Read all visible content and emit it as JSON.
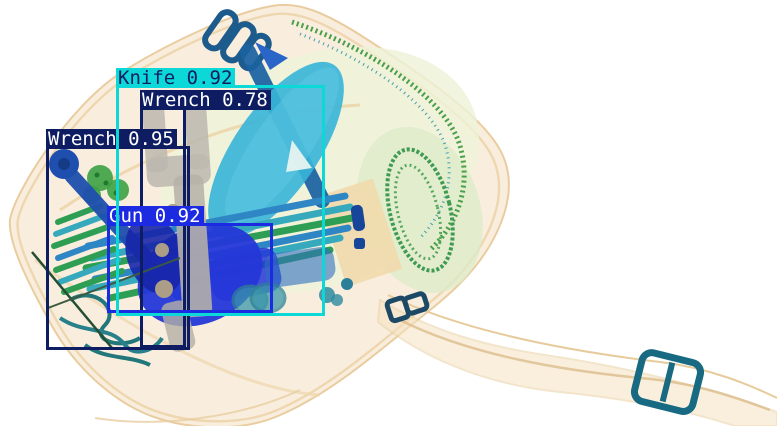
{
  "image": {
    "kind": "xray-baggage-scan",
    "background": "#ffffff"
  },
  "palette": {
    "cyan_box": "#0cd8d8",
    "navy_box": "#0e1d62",
    "blue_box": "#1c2ae2",
    "label_text_light": "#ffffff",
    "label_text_dark": "#0e1d62"
  },
  "detections": [
    {
      "label": "Wrench",
      "score": "0.78",
      "display": "Wrench 0.78",
      "color": "#0e1d62",
      "text_color": "#ffffff",
      "stroke": 3,
      "box": {
        "x": 140,
        "y": 107,
        "w": 46,
        "h": 241
      }
    },
    {
      "label": "Wrench",
      "score": "0.95",
      "display": "Wrench 0.95",
      "color": "#0e1d62",
      "text_color": "#ffffff",
      "stroke": 3,
      "box": {
        "x": 46,
        "y": 146,
        "w": 144,
        "h": 204
      }
    },
    {
      "label": "Gun",
      "score": "0.92",
      "display": "Gun 0.92",
      "color": "#1c2ae2",
      "text_color": "#ffffff",
      "stroke": 3,
      "box": {
        "x": 107,
        "y": 223,
        "w": 166,
        "h": 90
      }
    },
    {
      "label": "Knife",
      "score": "0.92",
      "display": "Knife 0.92",
      "color": "#0cd8d8",
      "text_color": "#0e1d62",
      "stroke": 3,
      "box": {
        "x": 116,
        "y": 85,
        "w": 209,
        "h": 231
      }
    }
  ]
}
